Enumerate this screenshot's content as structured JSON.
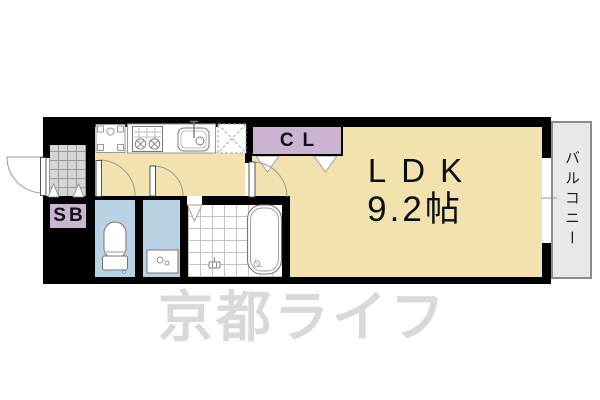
{
  "plan": {
    "ldk_label": "LDK",
    "ldk_size": "9.2帖",
    "closet_label": "CL",
    "shoebox_label": "SB",
    "balcony_label": "バルコニー",
    "watermark": "京都ライフ"
  },
  "colors": {
    "floor_beige": "#F1E2AE",
    "accent_purple": "#CBB4D2",
    "room_blue": "#B9D2E4",
    "entrance_tile_gray": "#D6D6D6",
    "balcony_gray": "#E9E9E9",
    "wall_black": "#000000",
    "fixture_line_gray": "#888888",
    "watermark_gray": "#D4D4D4"
  }
}
